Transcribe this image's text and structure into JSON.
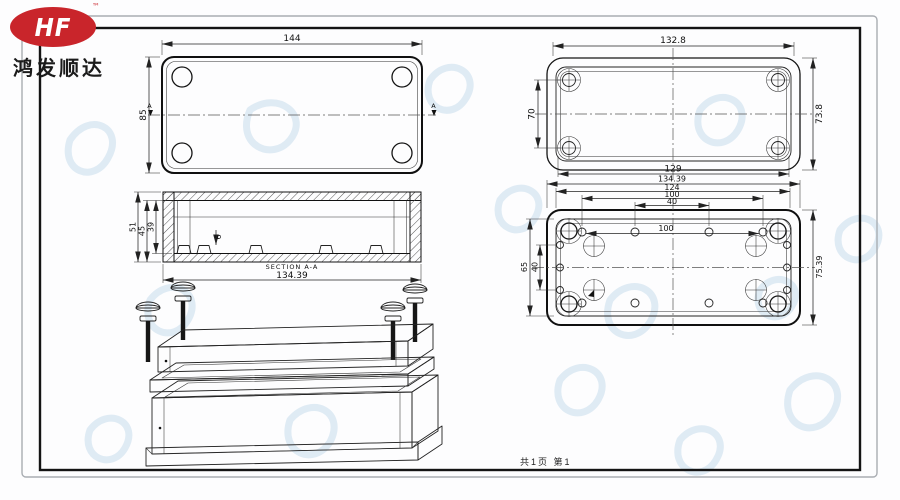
{
  "logo": {
    "monogram": "HF",
    "trademark": "™",
    "company_name": "鸿发顺达",
    "brand_color": "#c9252b"
  },
  "footer": {
    "page_info": "共1页 第1"
  },
  "drawing": {
    "lid_top_view": {
      "dim_width": "144",
      "dim_height": "85",
      "section_marker": "A"
    },
    "lid_inner_view": {
      "dim_width_top": "132.8",
      "dim_height_left": "70",
      "dim_height_right": "73.8",
      "dim_width_bottom": "129"
    },
    "section_view": {
      "title": "SECTION A-A",
      "dim_width": "134.39",
      "dim_height_outer": "51",
      "dim_height_mid": "45",
      "dim_height_inner": "39",
      "dim_boss_height": "6"
    },
    "base_bottom_view": {
      "dim_width_outer": "134.39",
      "dim_width_bolt_span": "124",
      "dim_width_holes_outer": "100",
      "dim_width_holes_inner": "40",
      "dim_width_holes_row": "100",
      "dim_height_left_outer": "65",
      "dim_height_left_inner": "40",
      "dim_height_right": "75.39"
    }
  }
}
